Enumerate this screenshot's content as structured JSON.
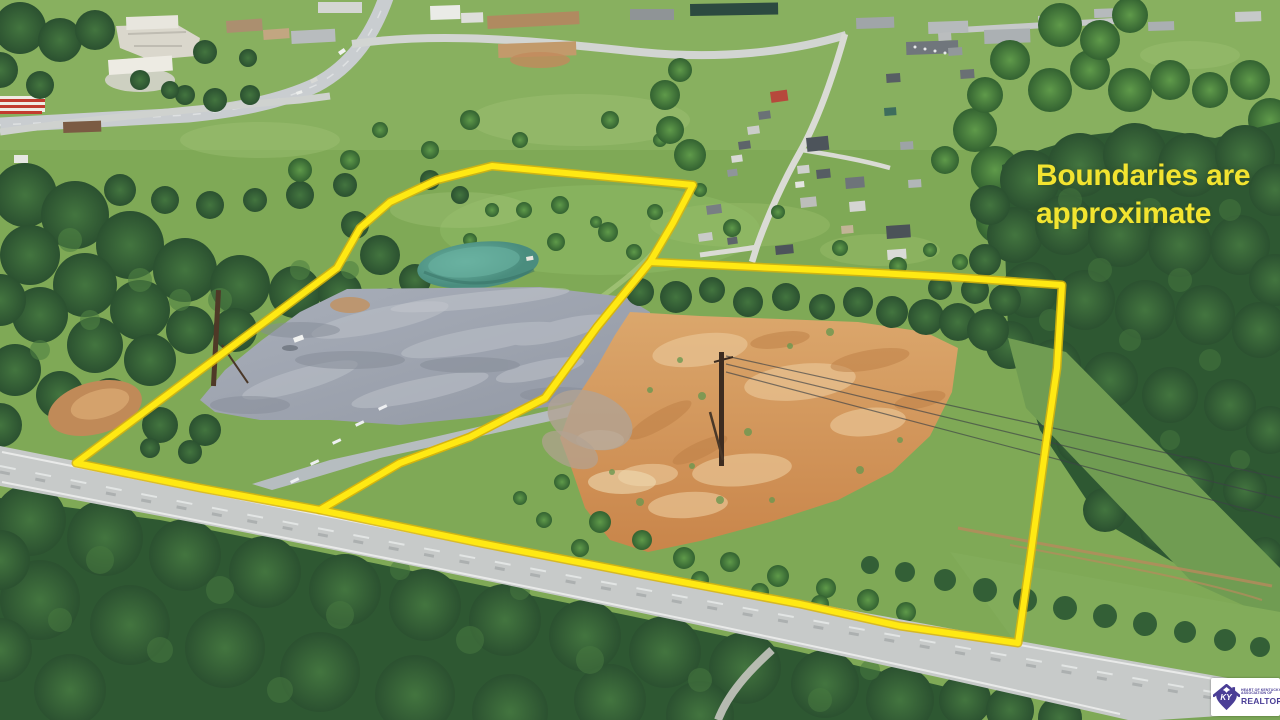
{
  "overlay": {
    "line1": "Boundaries are",
    "line2": "approximate",
    "color": "#f2e430"
  },
  "boundaries": {
    "stroke_color": "#ffe913",
    "casing_color": "#d8b50b",
    "left_parcel_points": "492,166 693,185 673,223 650,262 597,327 545,398 470,437 400,463 320,510 200,488 76,463 337,268 360,228 390,202 437,180",
    "right_parcel_points": "650,262 860,272 950,277 1062,285 1057,368 1048,430 1030,560 1018,643 900,626 800,604 640,574 480,543 320,510 400,463 470,437 545,398 597,327"
  },
  "logo": {
    "monogram": "KY",
    "org_line1": "HEART OF KENTUCKY",
    "org_line2": "ASSOCIATION OF",
    "name": "REALTORS",
    "registered": "®",
    "purple": "#4a3e96",
    "background": "#ffffff"
  },
  "colors": {
    "field_green": "#7fa956",
    "forest_green": "#2e5833",
    "gravel_pad": "#9ba3ad",
    "cleared_dirt": "#d2975e",
    "pond_water": "#57a08f",
    "asphalt_road": "#c7cac9"
  }
}
